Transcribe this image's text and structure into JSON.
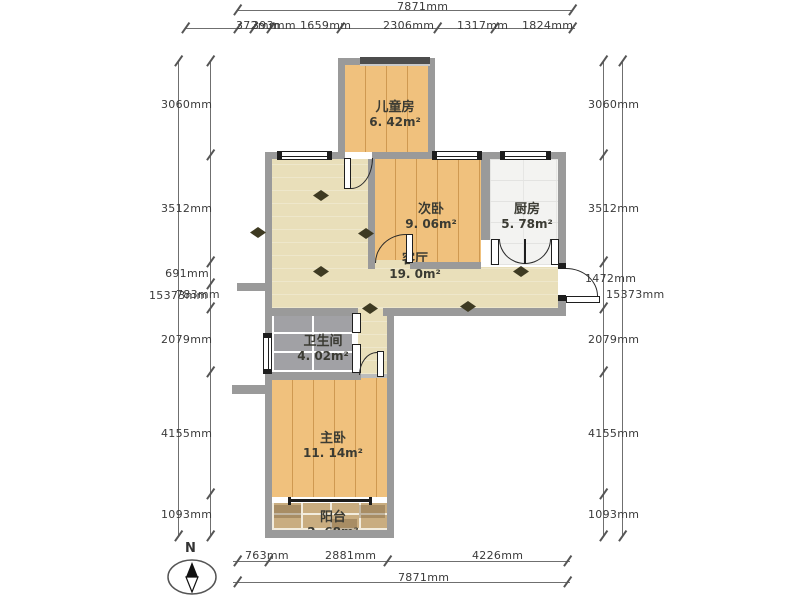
{
  "plan": {
    "rooms": [
      {
        "id": "children-room",
        "name": "儿童房",
        "area": "6. 42m²"
      },
      {
        "id": "second-bedroom",
        "name": "次卧",
        "area": "9. 06m²"
      },
      {
        "id": "kitchen",
        "name": "厨房",
        "area": "5. 78m²"
      },
      {
        "id": "living-room",
        "name": "客厅",
        "area": "19. 0m²"
      },
      {
        "id": "bathroom",
        "name": "卫生间",
        "area": "4. 02m²"
      },
      {
        "id": "master-bedroom",
        "name": "主卧",
        "area": "11. 14m²"
      },
      {
        "id": "balcony",
        "name": "阳台",
        "area": "2. 68m²"
      }
    ]
  },
  "dimensions": {
    "top": {
      "total": "7871mm",
      "segments": [
        "372mm",
        "393mm",
        "1659mm",
        "2306mm",
        "1317mm",
        "1824mm"
      ]
    },
    "bottom": {
      "total": "7871mm",
      "segments": [
        "763mm",
        "2881mm",
        "4226mm"
      ]
    },
    "left": {
      "total": "15373mm",
      "segments": [
        "3060mm",
        "3512mm",
        "691mm",
        "783mm",
        "2079mm",
        "4155mm",
        "1093mm"
      ]
    },
    "right": {
      "total": "15373mm",
      "segments": [
        "3060mm",
        "3512mm",
        "1472mm",
        "2079mm",
        "4155mm",
        "1093mm"
      ]
    }
  },
  "compass": {
    "label": "N"
  },
  "colors": {
    "wall": "#9a9a9a",
    "wood_floor": "#f0c17d",
    "living_floor": "#e9dfba",
    "kitchen_tile": "#f3f3f1",
    "bath_tile": "#a1a1a5",
    "balcony_tile": "#c9ad80",
    "diamond_accent": "#3e3a22"
  }
}
